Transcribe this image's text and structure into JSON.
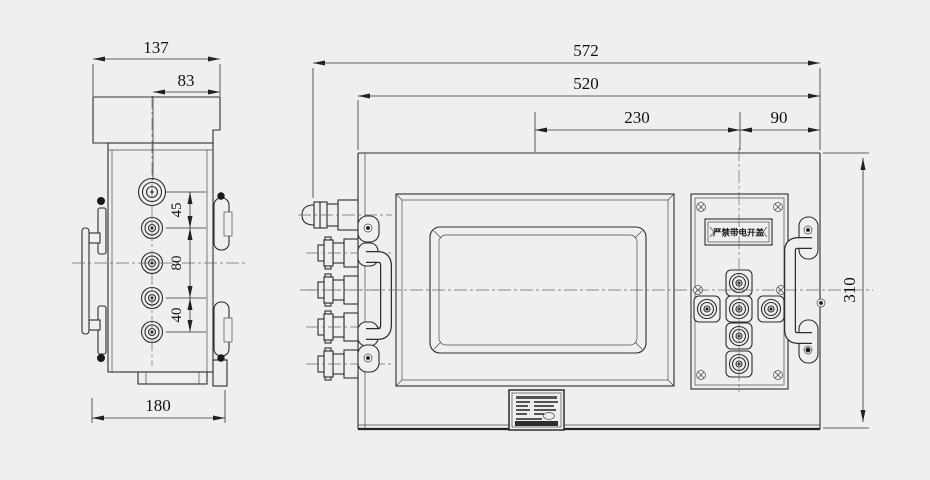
{
  "drawing": {
    "kind": "engineering-drawing",
    "colors": {
      "background": "#efefef",
      "line": "#2d2d2d",
      "centerline": "#6a6a6a",
      "dim_text": "#111111"
    },
    "dimensions": {
      "side_view": {
        "cover_depth": "137",
        "gland_axis_offset": "83",
        "gland_gap_top": "45",
        "gland_gap_middle": "80",
        "gland_gap_bottom": "40",
        "base_depth": "180"
      },
      "front_view": {
        "overall_width": "572",
        "enclosure_width": "520",
        "window_center_to_buttons": "230",
        "buttons_to_edge": "90",
        "enclosure_height": "310"
      }
    },
    "labels": {
      "warning_plate": "严禁带电开盖"
    }
  }
}
